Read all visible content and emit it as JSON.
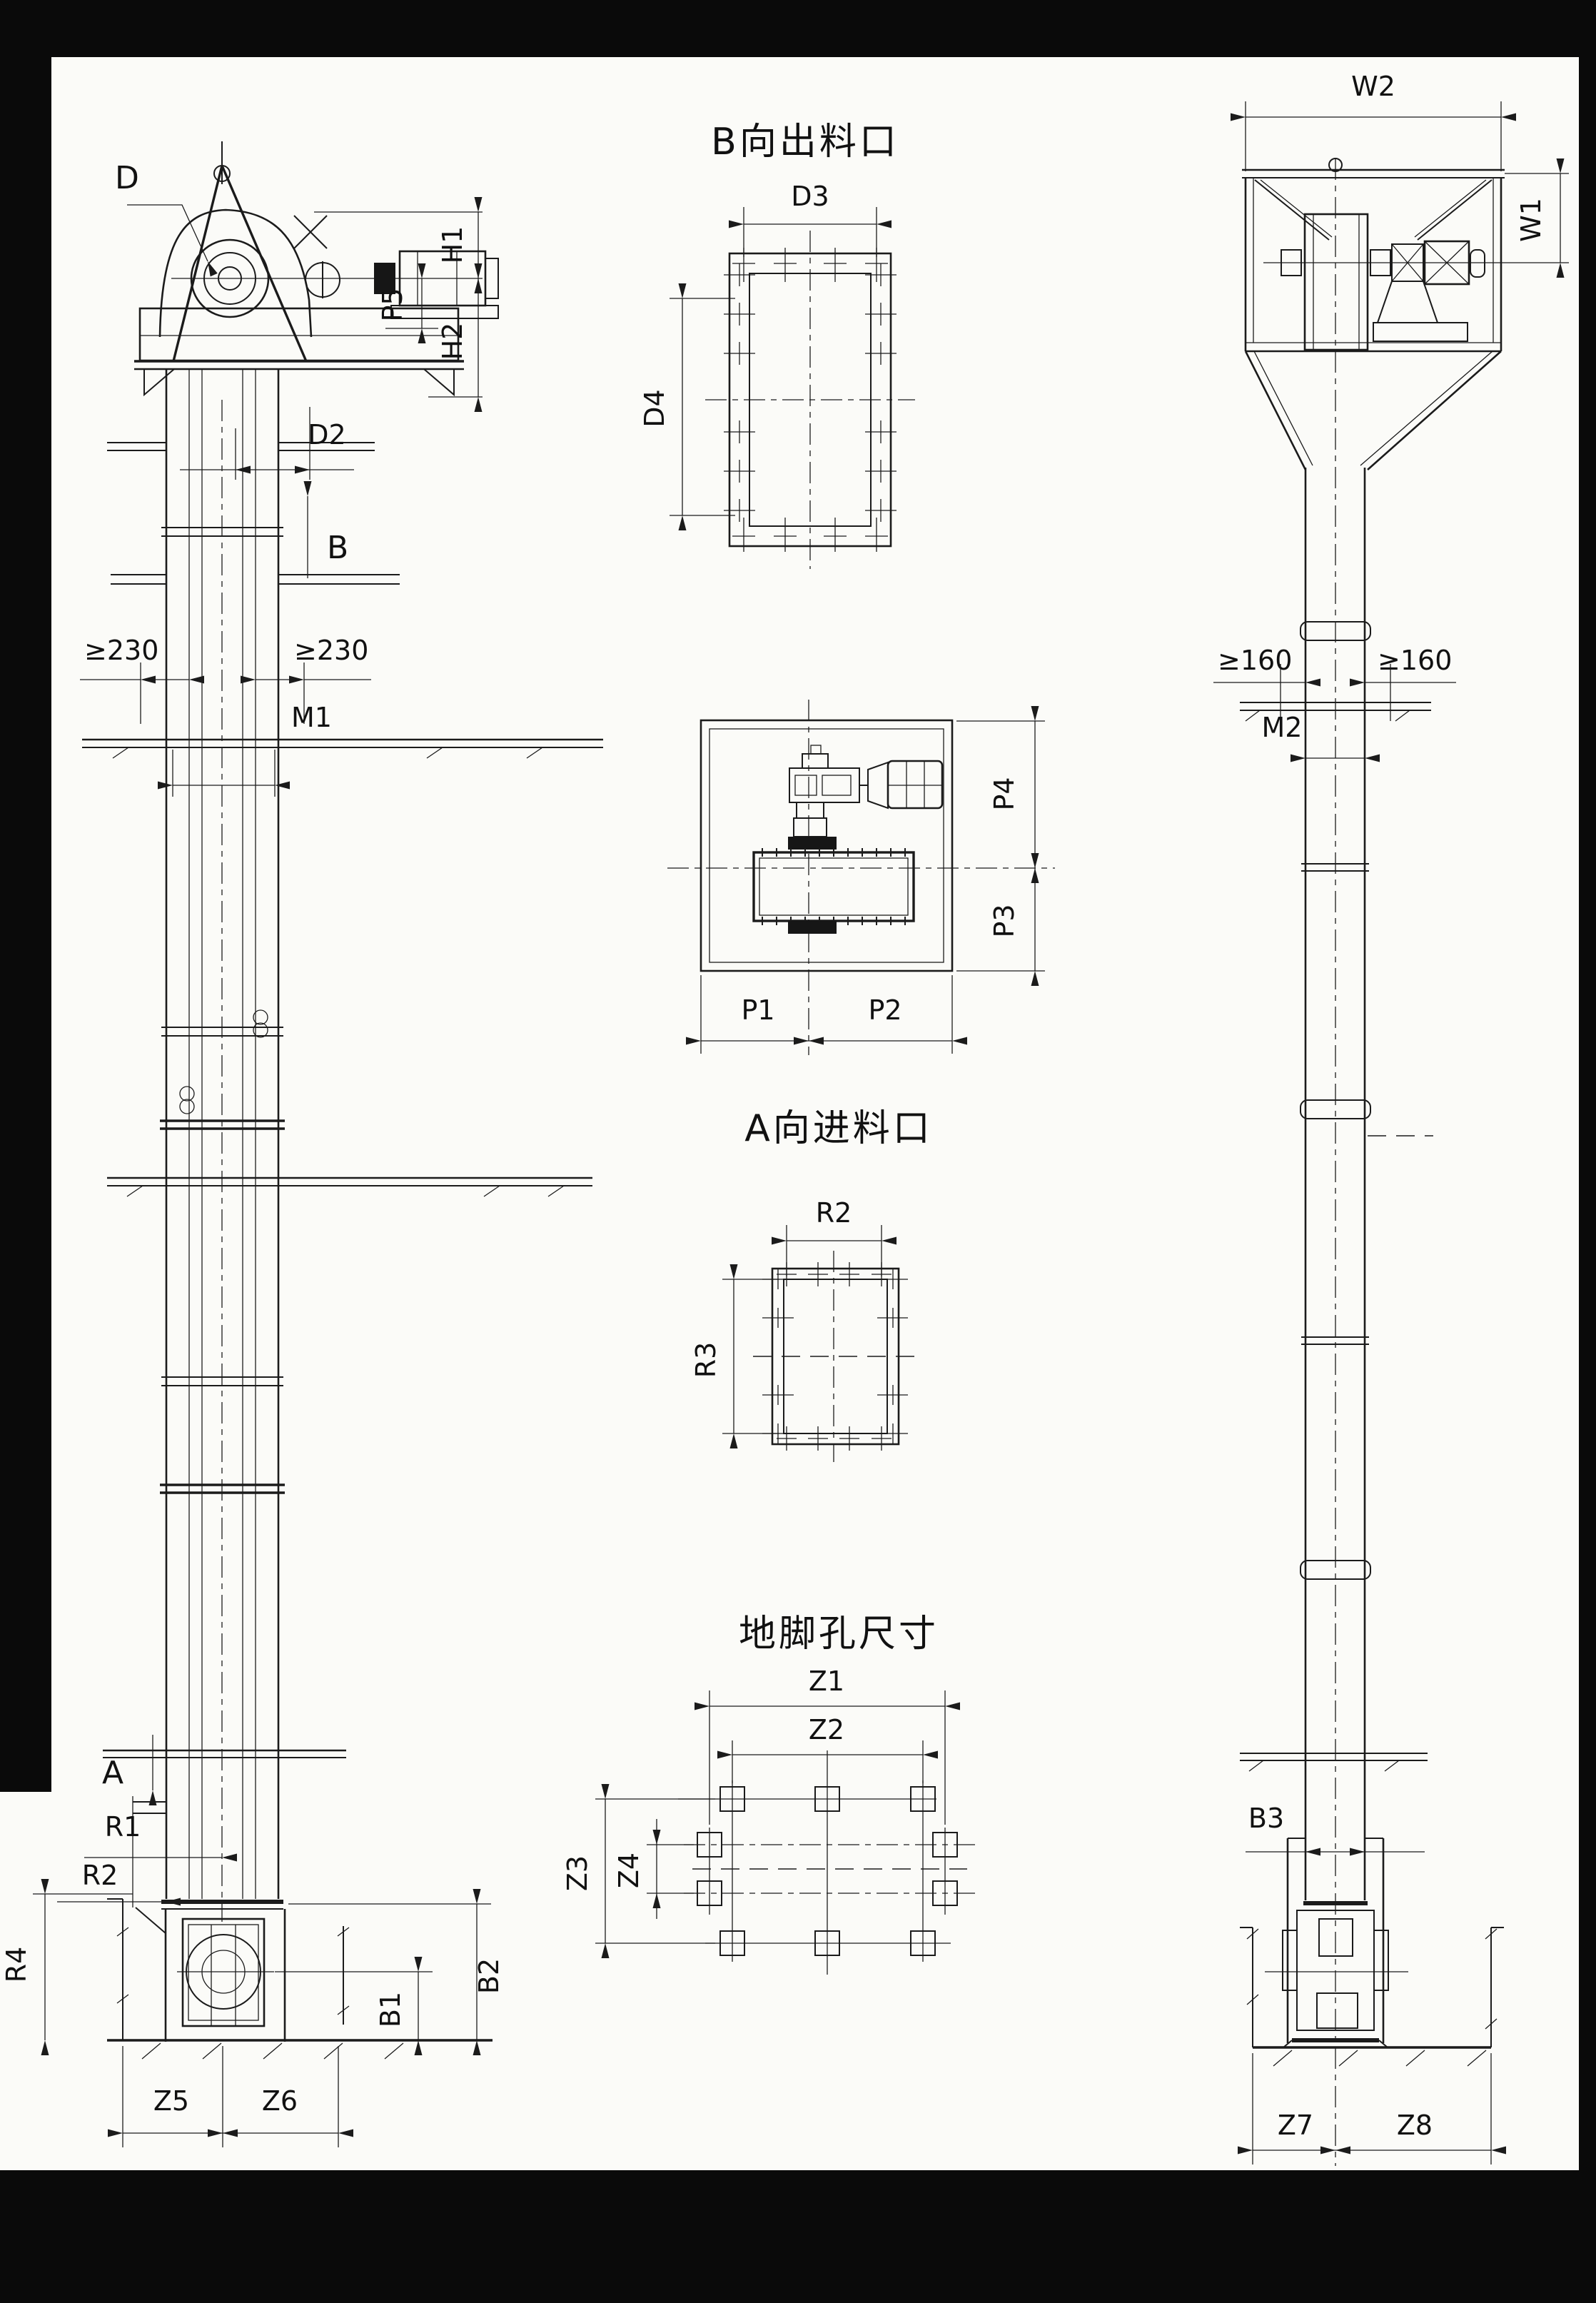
{
  "titles": {
    "discharge": "B向出料口",
    "inlet": "A向进料口",
    "anchor": "地脚孔尺寸"
  },
  "front_view": {
    "d": "D",
    "h1": "H1",
    "h2": "H2",
    "p5": "P5",
    "d2": "D2",
    "b": "B",
    "clearance_left": "≥230",
    "clearance_right": "≥230",
    "m1": "M1",
    "a": "A",
    "r1": "R1",
    "r2": "R2",
    "r4": "R4",
    "b1": "B1",
    "b2": "B2",
    "z5": "Z5",
    "z6": "Z6"
  },
  "discharge_port": {
    "d3": "D3",
    "d4": "D4"
  },
  "drive_plan": {
    "p1": "P1",
    "p2": "P2",
    "p3": "P3",
    "p4": "P4"
  },
  "inlet_port": {
    "r2": "R2",
    "r3": "R3"
  },
  "anchor_plan": {
    "z1": "Z1",
    "z2": "Z2",
    "z3": "Z3",
    "z4": "Z4"
  },
  "side_view": {
    "w1": "W1",
    "w2": "W2",
    "clearance_left": "≥160",
    "clearance_right": "≥160",
    "m2": "M2",
    "b3": "B3",
    "z7": "Z7",
    "z8": "Z8"
  }
}
